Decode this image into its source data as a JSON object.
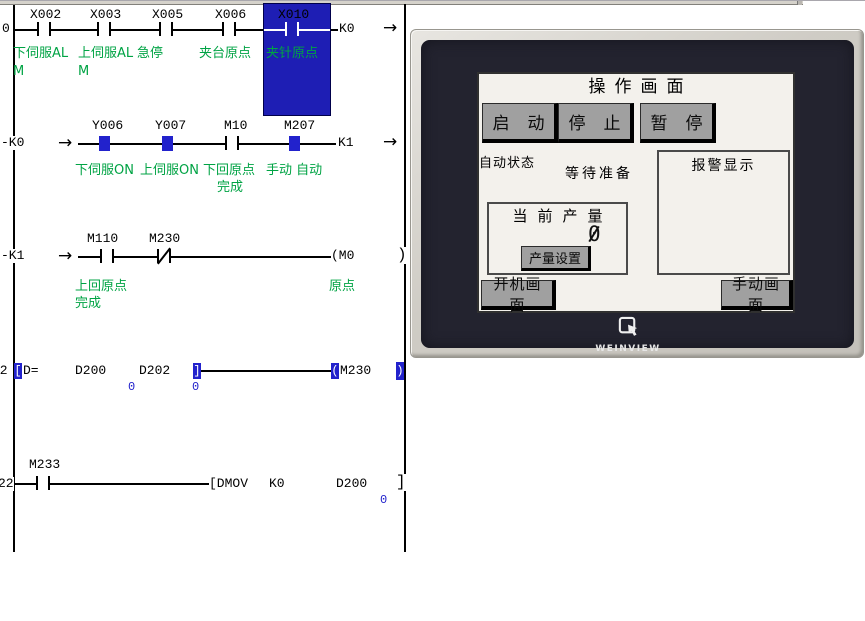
{
  "ladder": {
    "rung1": {
      "number": "0",
      "contacts": [
        {
          "label": "X002",
          "comment": "下伺服AL",
          "comment2": "M"
        },
        {
          "label": "X003",
          "comment": "上伺服AL",
          "comment2": "M"
        },
        {
          "label": "X005",
          "comment": "急停"
        },
        {
          "label": "X006",
          "comment": "夹台原点"
        },
        {
          "label": "X010",
          "comment": "夹针原点"
        }
      ],
      "out_label": "K0"
    },
    "rung2": {
      "left_label": "-K0",
      "elements": [
        {
          "label": "Y006",
          "comment": "下伺服ON"
        },
        {
          "label": "Y007",
          "comment": "上伺服ON"
        },
        {
          "label": "M10",
          "comment": "下回原点",
          "comment2": "完成"
        },
        {
          "label": "M207",
          "comment": "手动 自动"
        }
      ],
      "out_label": "K1"
    },
    "rung3": {
      "left_label": "-K1",
      "contact1": {
        "label": "M110",
        "comment": "上回原点",
        "comment2": "完成"
      },
      "contact2": {
        "label": "M230"
      },
      "coil_label": "(M0",
      "coil_comment": "原点",
      "end_bracket": ")"
    },
    "rung4": {
      "number": "12",
      "open_bracket": "[",
      "mnemonic": "D=",
      "operand1": "D200",
      "operand2": "D202",
      "value1": "0",
      "value2": "0",
      "close_bracket": "]",
      "coil_open": "(",
      "coil_device": "M230",
      "end_bracket": ")"
    },
    "rung5": {
      "number": "22",
      "contact": {
        "label": "M233"
      },
      "instruction": "[DMOV",
      "operand1": "K0",
      "operand2": "D200",
      "value": "0",
      "end_bracket": "]"
    }
  },
  "hmi": {
    "title": "操作画面",
    "buttons": {
      "start": "启动",
      "stop": "停止",
      "pause": "暂停"
    },
    "status_label": "自动状态",
    "status_value": "等待准备",
    "alarm_title": "报警显示",
    "production": {
      "title": "当前产量",
      "value": "0",
      "set_button": "产量设置"
    },
    "nav": {
      "startup": "开机画面",
      "manual": "手动画面"
    },
    "brand": "WEINVIEW"
  },
  "colors": {
    "highlight_blue": "#2222cc",
    "selection_blue": "#1e1eb4",
    "comment_green": "#00a344",
    "bezel_dark": "#23232f",
    "button_gray": "#a0a0a0"
  }
}
